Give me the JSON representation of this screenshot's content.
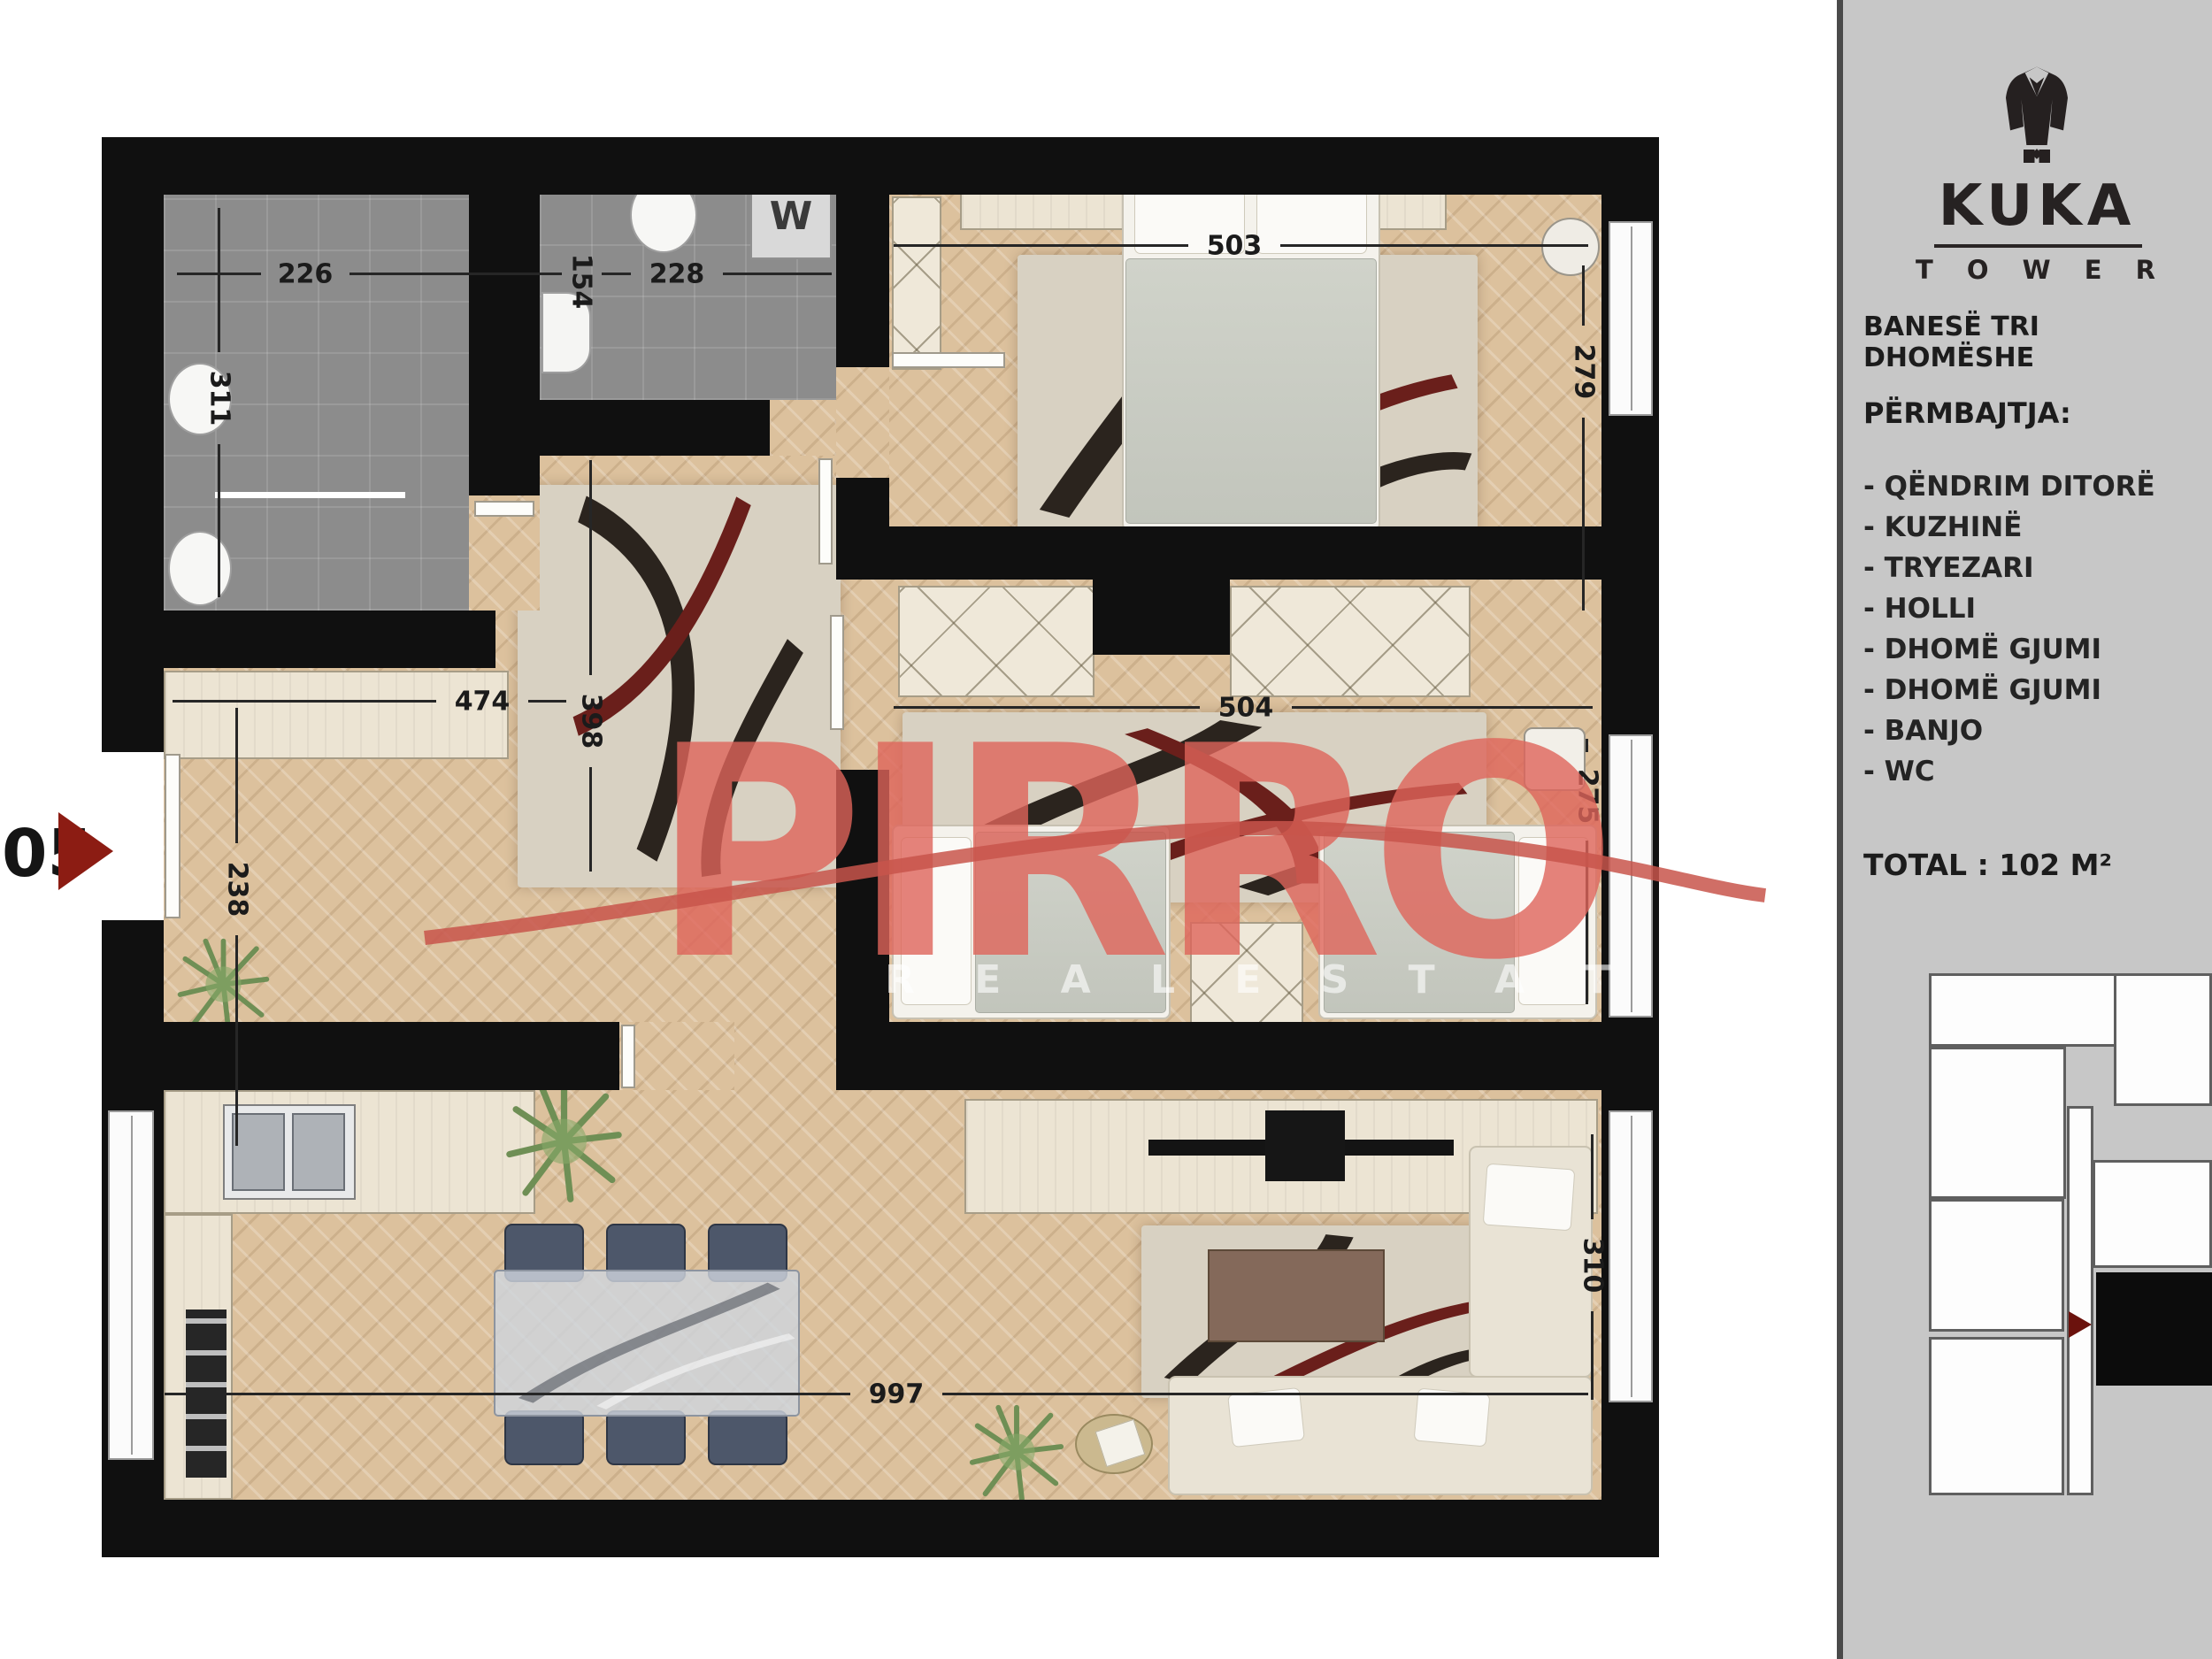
{
  "unit": {
    "number": "05"
  },
  "watermark": {
    "brand": "PIRRO",
    "tagline": "R E A L   E S T A T E"
  },
  "fixtures": {
    "washer_label": "W"
  },
  "dims": {
    "bath_width": "226",
    "wc_depth": "154",
    "wc_width": "228",
    "bath_depth": "311",
    "bed1_width": "503",
    "bed1_depth": "279",
    "hall_width": "474",
    "hall_depth": "398",
    "entry_depth": "238",
    "bed2_width": "504",
    "bed2_depth": "275",
    "living_width": "997",
    "living_depth": "310"
  },
  "sidebar": {
    "brand": {
      "logo": "suit-jacket-icon",
      "name": "KUKA",
      "subtitle": "T O W E R"
    },
    "title": "BANESË TRI DHOMËSHE",
    "contents_heading": "PËRMBAJTJA:",
    "items": [
      "- QËNDRIM DITORË",
      "- KUZHINË",
      "- TRYEZARI",
      "- HOLLI",
      "- DHOMË GJUMI",
      "- DHOMË GJUMI",
      "- BANJO",
      "- WC"
    ],
    "total": "TOTAL : 102 M²"
  },
  "colors": {
    "accent_red": "#8c1c13",
    "watermark_red": "#de645a",
    "wall": "#101010",
    "tile_floor": "#8c8c8c",
    "parquet_floor": "#dcc19d",
    "sidebar_bg": "#c7c7c7",
    "highlighted_unit": "#0c0c0c"
  }
}
